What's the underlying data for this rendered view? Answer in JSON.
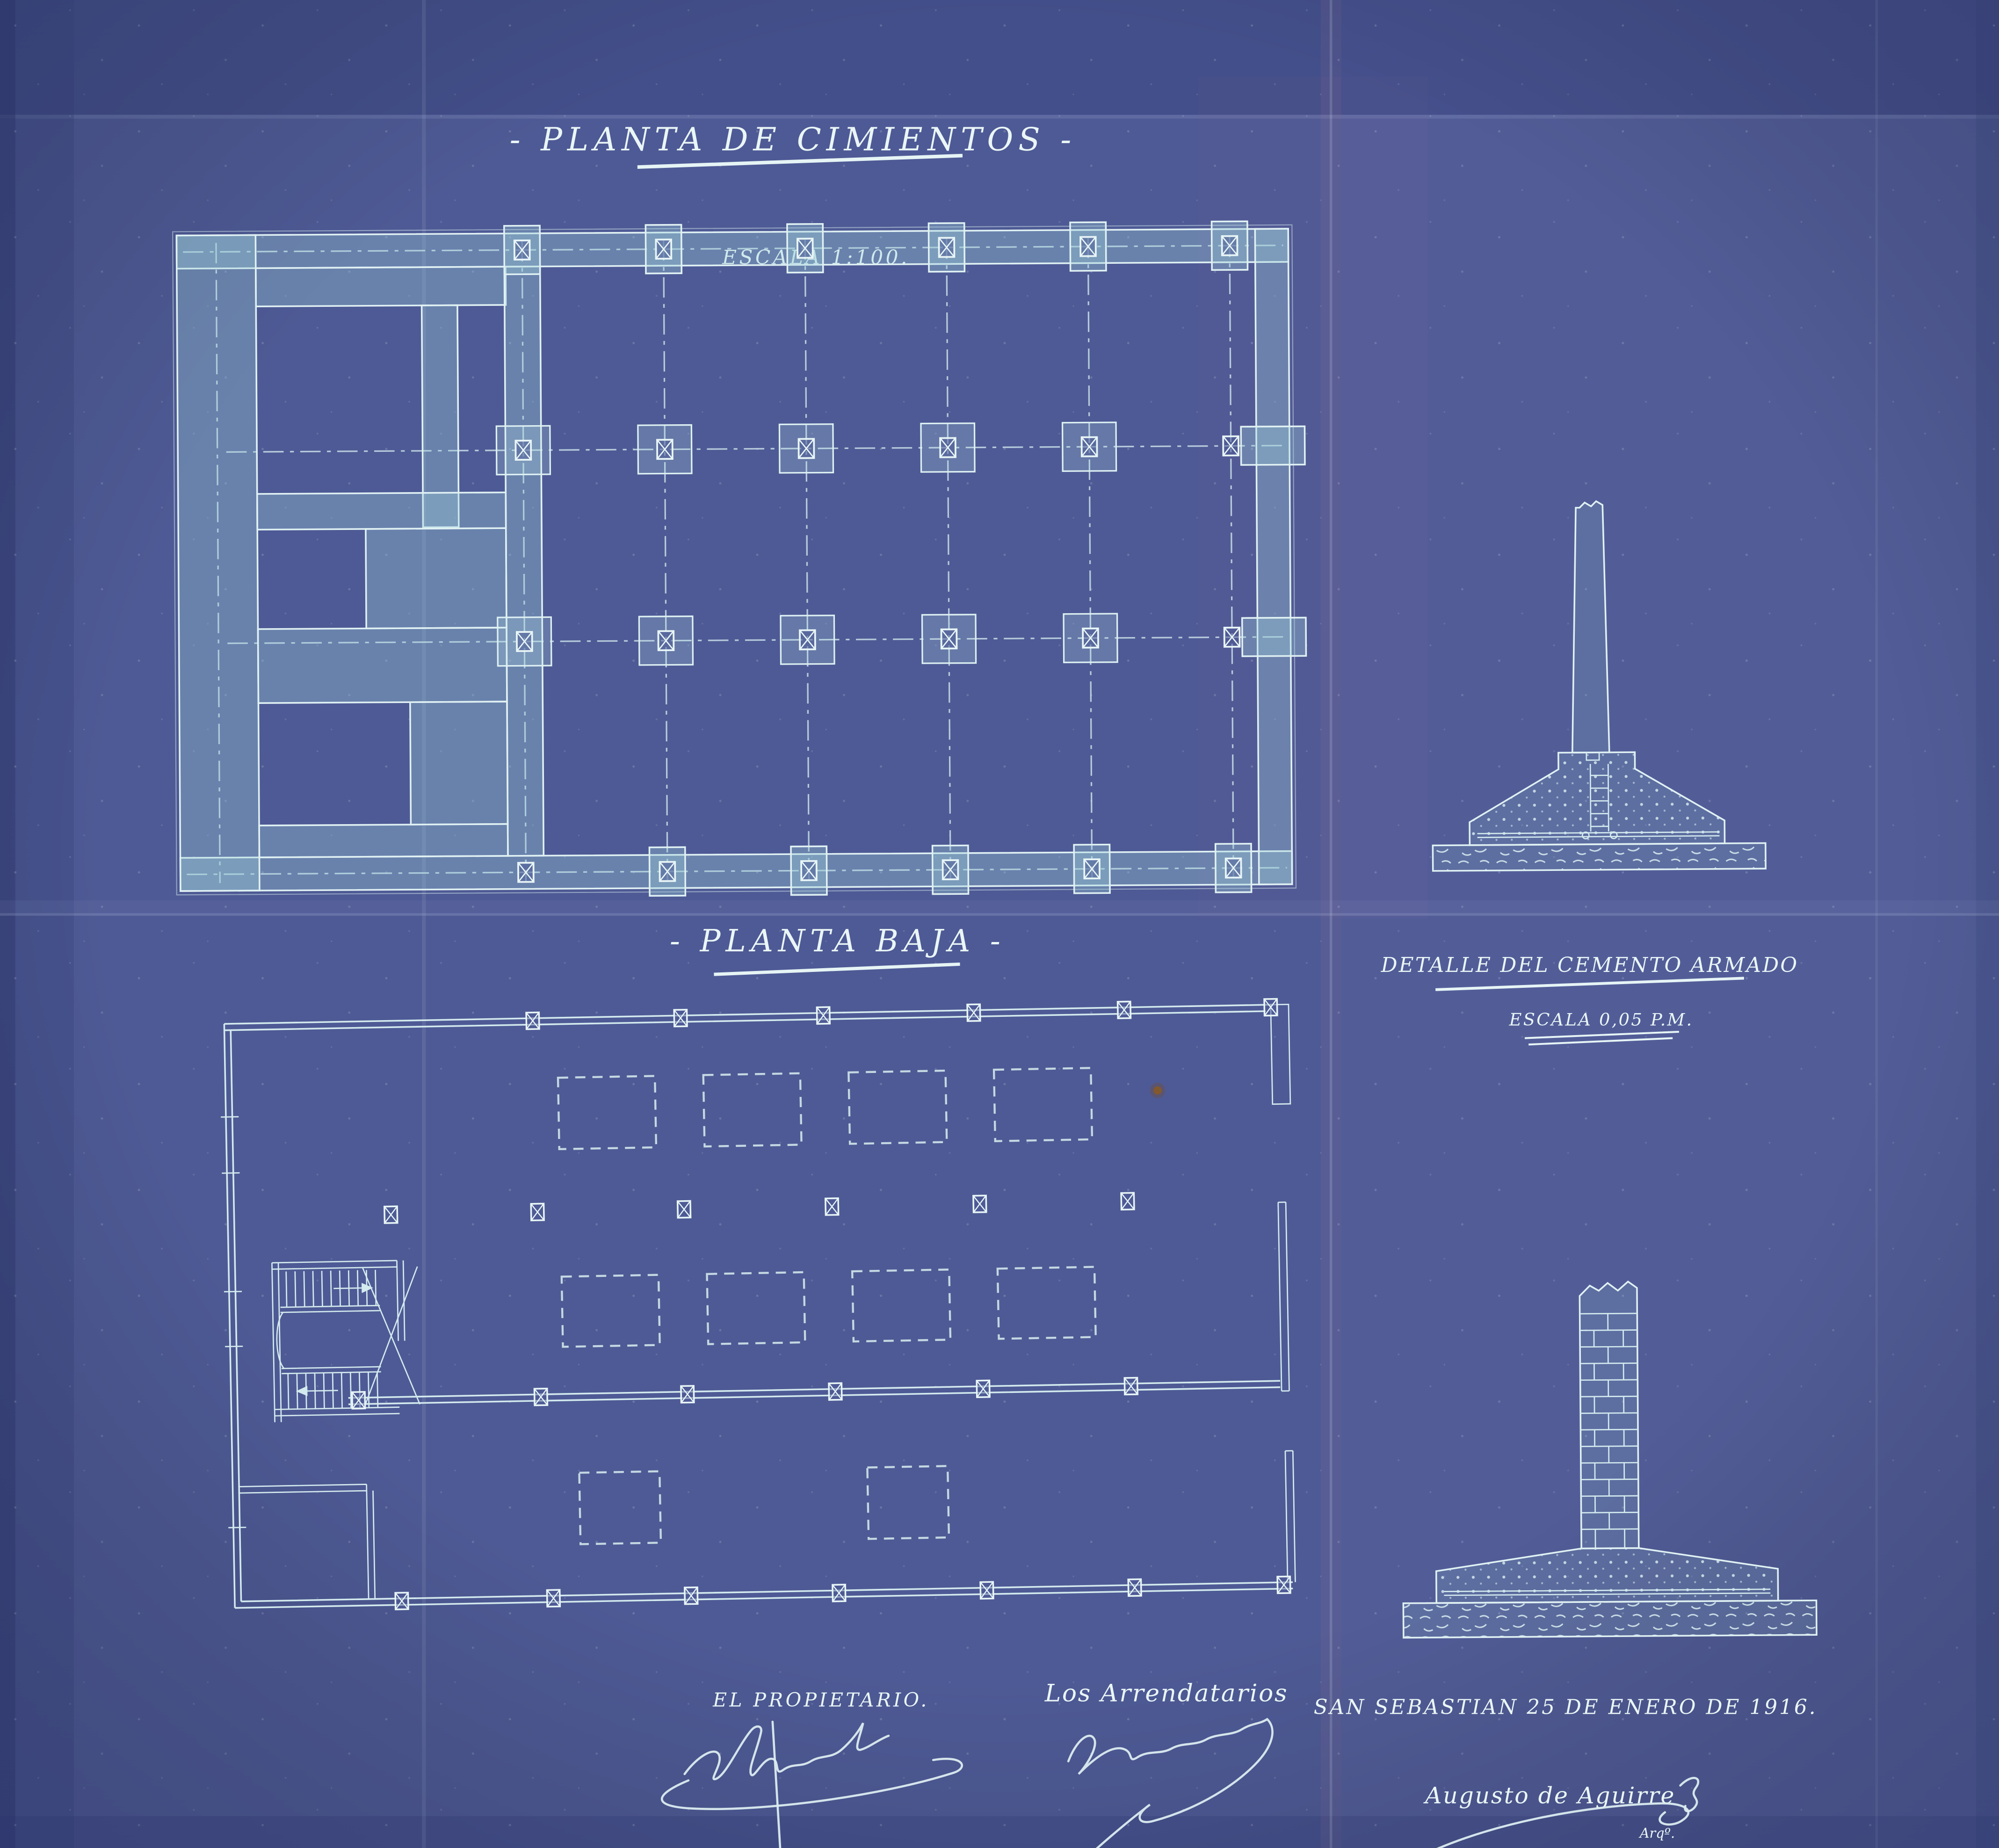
{
  "sheet": {
    "colors": {
      "paper": "#4e5a95",
      "line": "#d8ecef",
      "wall_fill": "#9fd0d8",
      "text": "#eaf6f6"
    },
    "foundation_plan": {
      "title": "- PLANTA DE CIMIENTOS -",
      "scale": "ESCALA 1:100."
    },
    "ground_floor_plan": {
      "title": "- PLANTA BAJA -"
    },
    "detail": {
      "title": "DETALLE DEL CEMENTO ARMADO",
      "scale": "ESCALA 0,05 P.M."
    },
    "signatures": {
      "owner_label": "EL PROPIETARIO.",
      "tenants_label": "Los Arrendatarios",
      "place_date": "SAN SEBASTIAN 25 DE ENERO DE 1916.",
      "architect_name": "Augusto de Aguirre",
      "architect_title": "Arqº."
    }
  }
}
